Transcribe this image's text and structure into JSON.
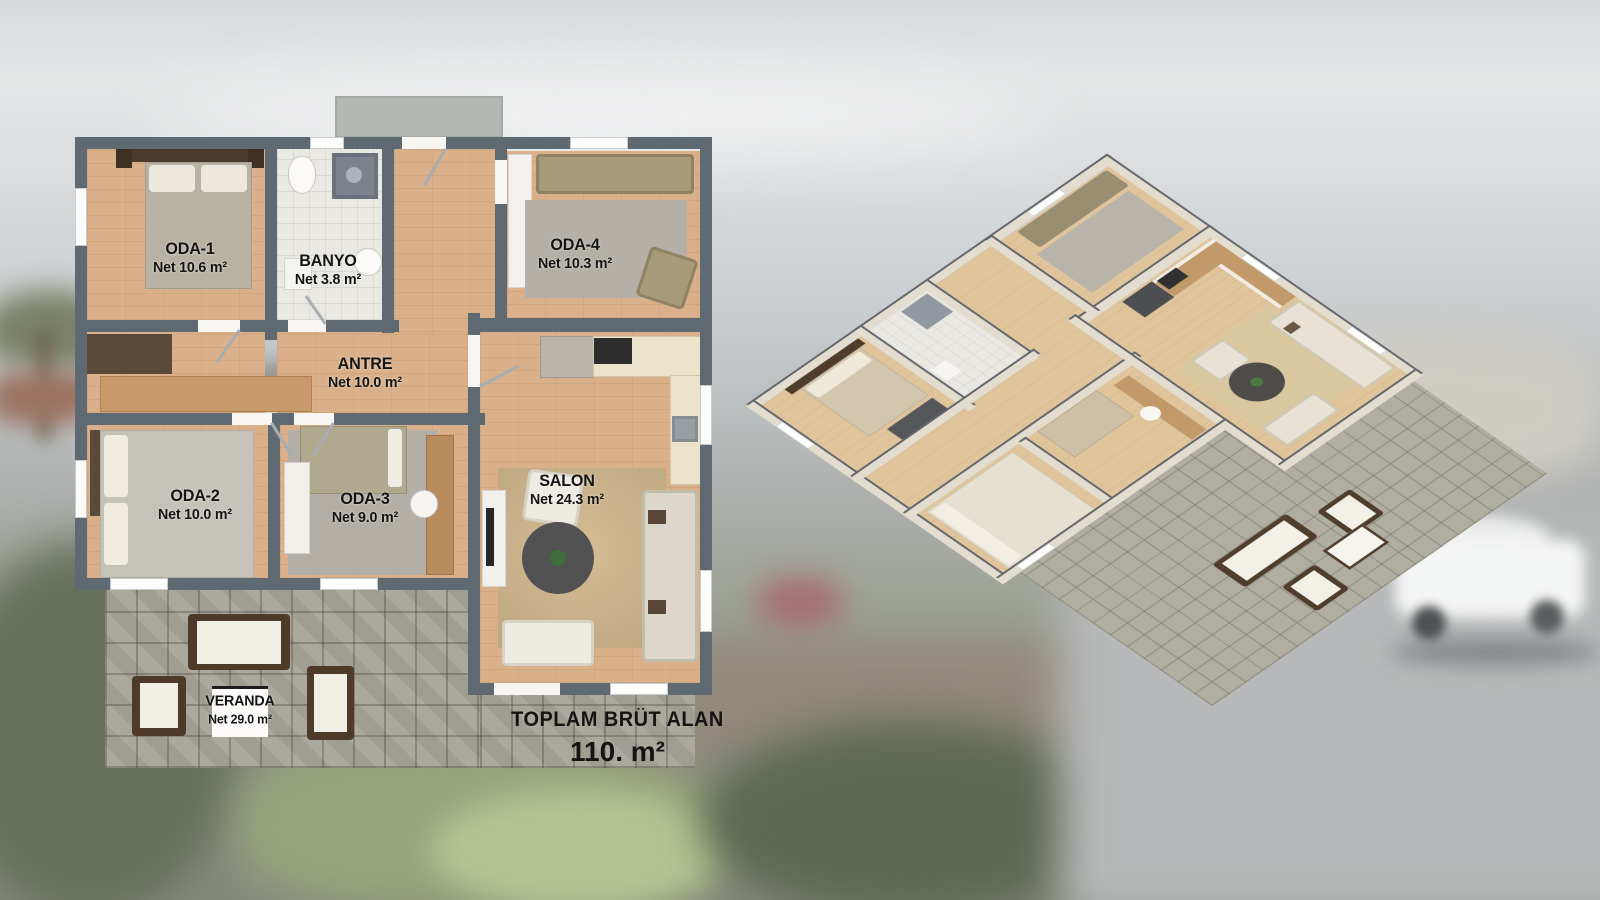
{
  "plan2d": {
    "rooms": [
      {
        "name": "ODA-1",
        "area": "Net 10.6 m²"
      },
      {
        "name": "BANYO",
        "area": "Net 3.8 m²"
      },
      {
        "name": "ODA-4",
        "area": "Net 10.3 m²"
      },
      {
        "name": "ANTRE",
        "area": "Net 10.0 m²"
      },
      {
        "name": "ODA-2",
        "area": "Net 10.0 m²"
      },
      {
        "name": "ODA-3",
        "area": "Net 9.0 m²"
      },
      {
        "name": "SALON",
        "area": "Net 24.3 m²"
      },
      {
        "name": "VERANDA",
        "area": "Net 29.0 m²"
      }
    ],
    "total_label": "TOPLAM BRÜT ALAN",
    "total_value": "110. m²"
  },
  "colors": {
    "wall_2d": "#5f6971",
    "wood_floor": "#d9b089",
    "bath_tile": "#eae8e2",
    "veranda_tile": "#a7a398",
    "label_text": "#141414",
    "iso_wall_face": "#e3ddd0",
    "iso_wall_cap": "#62656a"
  }
}
